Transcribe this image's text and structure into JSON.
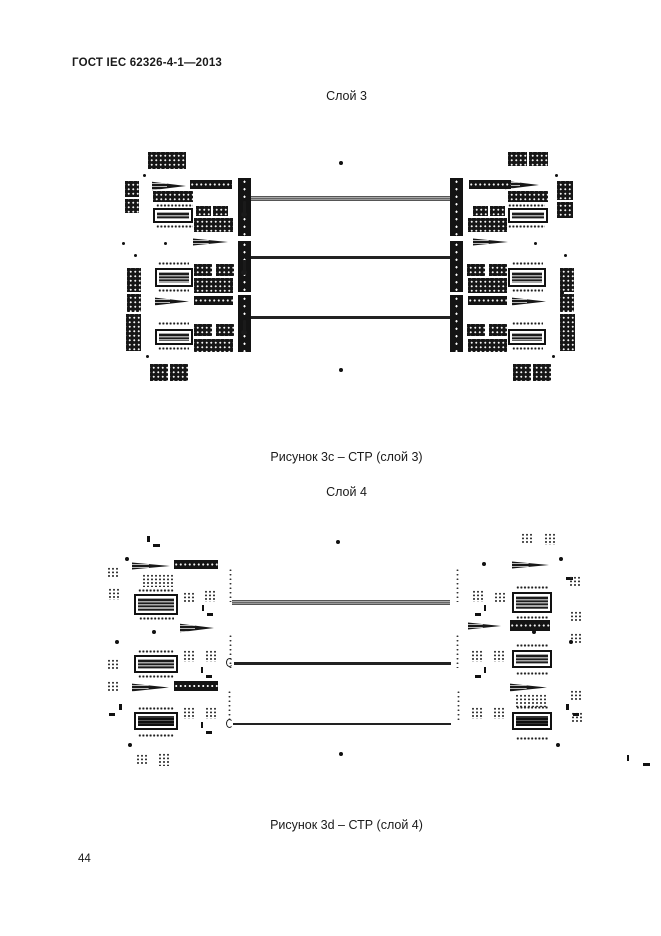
{
  "page": {
    "header": "ГОСТ IEC 62326-4-1—2013",
    "page_number": "44"
  },
  "colors": {
    "ink": "#1a1a1a",
    "trace_dark": "#222222",
    "trace_bundle_gray": "#888888",
    "background": "#ffffff"
  },
  "shape_names": {
    "blk": "pad-array-block",
    "bar": "dotted-black-bar",
    "grid": "pad-dot-grid",
    "pins": "pin-row",
    "ic": "ic-component",
    "icd": "ic-component-dark",
    "wedge": "taper-wedge",
    "vbar": "connector-bar",
    "vdots": "via-column",
    "trace": "signal-trace-bundle",
    "trace2": "signal-trace",
    "stub": "trace-stub",
    "hook": "trace-hook",
    "dot": "fiducial-dot",
    "tick": "tick-mark",
    "dash": "dash-mark"
  },
  "figures": [
    {
      "title": "Слой 3",
      "caption": "Рисунок 3c – СТР (слой 3)",
      "shapes": [
        [
          "blk",
          148,
          152,
          38,
          17
        ],
        [
          "dot",
          143,
          174,
          3,
          3
        ],
        [
          "blk",
          125,
          181,
          14,
          16
        ],
        [
          "blk",
          125,
          199,
          14,
          14
        ],
        [
          "wedge",
          152,
          180,
          34,
          12
        ],
        [
          "bar",
          190,
          180,
          42,
          9
        ],
        [
          "blk",
          153,
          191,
          40,
          11
        ],
        [
          "pins",
          156,
          204,
          37,
          3
        ],
        [
          "ic",
          153,
          208,
          40,
          15
        ],
        [
          "pins",
          156,
          225,
          37,
          3
        ],
        [
          "blk",
          196,
          206,
          15,
          10
        ],
        [
          "blk",
          213,
          206,
          15,
          10
        ],
        [
          "blk",
          194,
          218,
          39,
          14
        ],
        [
          "vbar",
          238,
          178,
          13,
          58
        ],
        [
          "wedge",
          193,
          237,
          35,
          10
        ],
        [
          "dot",
          164,
          242,
          3,
          3
        ],
        [
          "vbar",
          238,
          241,
          13,
          51
        ],
        [
          "dot",
          134,
          254,
          3,
          3
        ],
        [
          "blk",
          127,
          268,
          14,
          24
        ],
        [
          "blk",
          127,
          294,
          14,
          18
        ],
        [
          "blk",
          126,
          314,
          15,
          37
        ],
        [
          "pins",
          158,
          262,
          31,
          3
        ],
        [
          "ic",
          155,
          268,
          38,
          19
        ],
        [
          "pins",
          158,
          289,
          31,
          3
        ],
        [
          "blk",
          194,
          264,
          18,
          12
        ],
        [
          "blk",
          216,
          264,
          18,
          12
        ],
        [
          "blk",
          194,
          278,
          39,
          15
        ],
        [
          "wedge",
          155,
          296,
          34,
          11
        ],
        [
          "bar",
          194,
          296,
          39,
          9
        ],
        [
          "vbar",
          238,
          295,
          13,
          57
        ],
        [
          "pins",
          158,
          322,
          31,
          3
        ],
        [
          "ic",
          155,
          329,
          38,
          16
        ],
        [
          "pins",
          158,
          347,
          31,
          3
        ],
        [
          "blk",
          194,
          324,
          18,
          12
        ],
        [
          "blk",
          216,
          324,
          18,
          12
        ],
        [
          "blk",
          194,
          339,
          39,
          13
        ],
        [
          "dot",
          146,
          355,
          3,
          3
        ],
        [
          "blk",
          150,
          364,
          18,
          17
        ],
        [
          "blk",
          170,
          364,
          18,
          17
        ],
        [
          "trace",
          251,
          196,
          199,
          5
        ],
        [
          "trace2",
          251,
          256,
          200,
          3
        ],
        [
          "trace2",
          251,
          316,
          200,
          3
        ],
        [
          "stub",
          243,
          201,
          3,
          12
        ],
        [
          "stub",
          243,
          260,
          3,
          11
        ],
        [
          "stub",
          243,
          320,
          3,
          11
        ],
        [
          "stub",
          455,
          201,
          3,
          12
        ],
        [
          "stub",
          455,
          260,
          3,
          11
        ],
        [
          "stub",
          455,
          320,
          3,
          11
        ],
        [
          "dot",
          339,
          161,
          4,
          4
        ],
        [
          "dot",
          339,
          368,
          4,
          4
        ],
        [
          "dot",
          473,
          182,
          4,
          4
        ],
        [
          "dot",
          560,
          291,
          4,
          4
        ],
        [
          "dot",
          122,
          242,
          3,
          3
        ],
        [
          "blk",
          508,
          152,
          19,
          14
        ],
        [
          "blk",
          529,
          152,
          19,
          14
        ],
        [
          "dot",
          555,
          174,
          3,
          3
        ],
        [
          "blk",
          557,
          181,
          16,
          19
        ],
        [
          "blk",
          557,
          202,
          16,
          16
        ],
        [
          "wedge",
          505,
          179,
          34,
          12
        ],
        [
          "bar",
          469,
          180,
          42,
          9
        ],
        [
          "blk",
          508,
          191,
          40,
          11
        ],
        [
          "pins",
          508,
          204,
          37,
          3
        ],
        [
          "ic",
          508,
          208,
          40,
          15
        ],
        [
          "pins",
          508,
          225,
          37,
          3
        ],
        [
          "blk",
          490,
          206,
          15,
          10
        ],
        [
          "blk",
          473,
          206,
          15,
          10
        ],
        [
          "blk",
          468,
          218,
          39,
          14
        ],
        [
          "vbar",
          450,
          178,
          13,
          58
        ],
        [
          "wedge",
          473,
          237,
          35,
          10
        ],
        [
          "dot",
          534,
          242,
          3,
          3
        ],
        [
          "vbar",
          450,
          241,
          13,
          51
        ],
        [
          "dot",
          564,
          254,
          3,
          3
        ],
        [
          "blk",
          560,
          268,
          14,
          24
        ],
        [
          "blk",
          560,
          294,
          14,
          18
        ],
        [
          "blk",
          560,
          314,
          15,
          37
        ],
        [
          "pins",
          512,
          262,
          31,
          3
        ],
        [
          "ic",
          508,
          268,
          38,
          19
        ],
        [
          "pins",
          512,
          289,
          31,
          3
        ],
        [
          "blk",
          489,
          264,
          18,
          12
        ],
        [
          "blk",
          467,
          264,
          18,
          12
        ],
        [
          "blk",
          468,
          278,
          39,
          15
        ],
        [
          "wedge",
          512,
          296,
          34,
          11
        ],
        [
          "bar",
          468,
          296,
          39,
          9
        ],
        [
          "vbar",
          450,
          295,
          13,
          57
        ],
        [
          "pins",
          512,
          322,
          31,
          3
        ],
        [
          "ic",
          508,
          329,
          38,
          16
        ],
        [
          "pins",
          512,
          347,
          31,
          3
        ],
        [
          "blk",
          489,
          324,
          18,
          12
        ],
        [
          "blk",
          467,
          324,
          18,
          12
        ],
        [
          "blk",
          468,
          339,
          39,
          13
        ],
        [
          "dot",
          552,
          355,
          3,
          3
        ],
        [
          "blk",
          513,
          364,
          18,
          17
        ],
        [
          "blk",
          533,
          364,
          18,
          17
        ]
      ]
    },
    {
      "title": "Слой 4",
      "caption": "Рисунок 3d – СТР (слой 4)",
      "shapes": [
        [
          "tick",
          147,
          536,
          3,
          6
        ],
        [
          "dash",
          153,
          544,
          7,
          3
        ],
        [
          "dot",
          125,
          557,
          4,
          4
        ],
        [
          "wedge",
          132,
          561,
          38,
          10
        ],
        [
          "bar",
          174,
          560,
          44,
          9
        ],
        [
          "grid",
          107,
          567,
          12,
          11
        ],
        [
          "grid",
          108,
          588,
          12,
          12
        ],
        [
          "grid",
          142,
          574,
          31,
          13
        ],
        [
          "pins",
          138,
          589,
          36,
          3
        ],
        [
          "ic",
          134,
          594,
          44,
          21
        ],
        [
          "pins",
          139,
          617,
          35,
          3
        ],
        [
          "grid",
          183,
          592,
          11,
          10
        ],
        [
          "grid",
          204,
          590,
          12,
          12
        ],
        [
          "tick",
          202,
          605,
          2,
          6
        ],
        [
          "dash",
          207,
          613,
          6,
          3
        ],
        [
          "wedge",
          180,
          622,
          34,
          12
        ],
        [
          "dot",
          152,
          630,
          4,
          4
        ],
        [
          "dot",
          115,
          640,
          4,
          4
        ],
        [
          "vdots",
          229,
          568,
          3,
          34
        ],
        [
          "trace",
          232,
          600,
          218,
          5
        ],
        [
          "pins",
          138,
          650,
          36,
          3
        ],
        [
          "ic",
          134,
          655,
          44,
          18
        ],
        [
          "pins",
          138,
          675,
          36,
          3
        ],
        [
          "grid",
          183,
          650,
          12,
          12
        ],
        [
          "grid",
          205,
          650,
          12,
          12
        ],
        [
          "tick",
          201,
          667,
          2,
          6
        ],
        [
          "dash",
          206,
          675,
          6,
          3
        ],
        [
          "vdots",
          229,
          634,
          3,
          34
        ],
        [
          "hook",
          226,
          658,
          7,
          9
        ],
        [
          "trace2",
          234,
          662,
          217,
          3
        ],
        [
          "grid",
          107,
          659,
          11,
          11
        ],
        [
          "grid",
          107,
          681,
          11,
          10
        ],
        [
          "wedge",
          132,
          682,
          37,
          11
        ],
        [
          "bar",
          174,
          681,
          44,
          10
        ],
        [
          "tick",
          119,
          704,
          3,
          6
        ],
        [
          "dash",
          109,
          713,
          6,
          3
        ],
        [
          "pins",
          138,
          707,
          36,
          3
        ],
        [
          "icd",
          134,
          712,
          44,
          18
        ],
        [
          "pins",
          138,
          734,
          36,
          3
        ],
        [
          "grid",
          183,
          707,
          12,
          12
        ],
        [
          "grid",
          205,
          707,
          12,
          12
        ],
        [
          "tick",
          201,
          722,
          2,
          6
        ],
        [
          "dash",
          206,
          731,
          6,
          3
        ],
        [
          "vdots",
          228,
          690,
          3,
          32
        ],
        [
          "hook",
          226,
          719,
          7,
          9
        ],
        [
          "trace2",
          233,
          723,
          218,
          2
        ],
        [
          "dot",
          128,
          743,
          4,
          4
        ],
        [
          "grid",
          136,
          754,
          11,
          11
        ],
        [
          "grid",
          158,
          753,
          13,
          13
        ],
        [
          "dot",
          336,
          540,
          4,
          4
        ],
        [
          "dot",
          339,
          752,
          4,
          4
        ],
        [
          "grid",
          521,
          533,
          12,
          11
        ],
        [
          "grid",
          544,
          533,
          13,
          12
        ],
        [
          "dot",
          482,
          562,
          4,
          4
        ],
        [
          "dash",
          566,
          577,
          7,
          3
        ],
        [
          "wedge",
          512,
          560,
          37,
          10
        ],
        [
          "pins",
          516,
          586,
          32,
          3
        ],
        [
          "ic",
          512,
          592,
          40,
          21
        ],
        [
          "pins",
          516,
          616,
          32,
          3
        ],
        [
          "grid",
          494,
          592,
          11,
          10
        ],
        [
          "grid",
          472,
          590,
          12,
          12
        ],
        [
          "tick",
          484,
          605,
          2,
          6
        ],
        [
          "dash",
          475,
          613,
          6,
          3
        ],
        [
          "wedge",
          468,
          621,
          33,
          10
        ],
        [
          "bar",
          510,
          620,
          40,
          11
        ],
        [
          "vdots",
          456,
          568,
          3,
          34
        ],
        [
          "pins",
          516,
          644,
          32,
          3
        ],
        [
          "ic",
          512,
          650,
          40,
          18
        ],
        [
          "pins",
          516,
          672,
          32,
          3
        ],
        [
          "grid",
          493,
          650,
          12,
          12
        ],
        [
          "grid",
          471,
          650,
          12,
          12
        ],
        [
          "tick",
          484,
          667,
          2,
          6
        ],
        [
          "dash",
          475,
          675,
          6,
          3
        ],
        [
          "vdots",
          456,
          634,
          3,
          34
        ],
        [
          "wedge",
          510,
          682,
          37,
          11
        ],
        [
          "grid",
          515,
          694,
          32,
          13
        ],
        [
          "pins",
          516,
          706,
          32,
          3
        ],
        [
          "icd",
          512,
          712,
          40,
          18
        ],
        [
          "pins",
          516,
          737,
          32,
          3
        ],
        [
          "grid",
          493,
          707,
          12,
          12
        ],
        [
          "grid",
          471,
          707,
          12,
          12
        ],
        [
          "vdots",
          457,
          690,
          3,
          32
        ],
        [
          "grid",
          569,
          576,
          12,
          11
        ],
        [
          "grid",
          570,
          611,
          11,
          11
        ],
        [
          "grid",
          570,
          633,
          11,
          11
        ],
        [
          "grid",
          570,
          690,
          11,
          11
        ],
        [
          "grid",
          571,
          712,
          11,
          10
        ],
        [
          "dot",
          559,
          557,
          4,
          4
        ],
        [
          "dot",
          532,
          630,
          4,
          4
        ],
        [
          "dot",
          569,
          640,
          4,
          4
        ],
        [
          "dot",
          556,
          743,
          4,
          4
        ],
        [
          "tick",
          566,
          704,
          3,
          6
        ],
        [
          "dash",
          573,
          713,
          6,
          3
        ],
        [
          "tick",
          627,
          755,
          2,
          6
        ],
        [
          "dash",
          643,
          763,
          7,
          3
        ]
      ]
    }
  ]
}
